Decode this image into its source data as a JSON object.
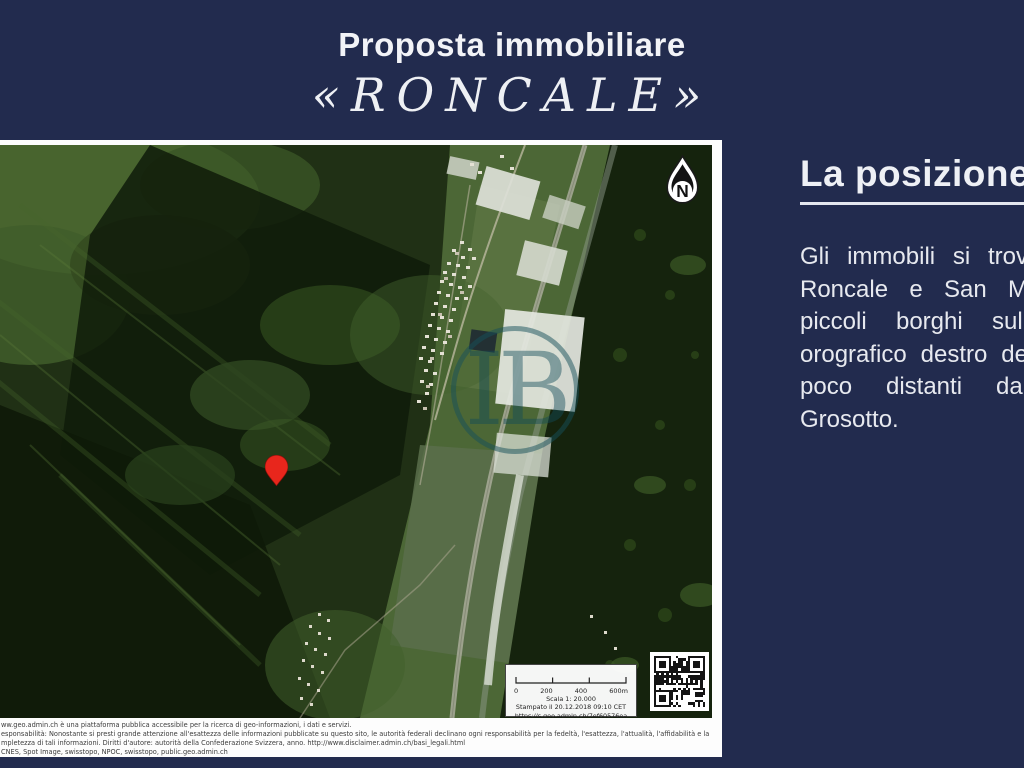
{
  "slide": {
    "title": "Proposta immobiliare",
    "subtitle": "«RONCALE»"
  },
  "right_panel": {
    "heading": "La posizione",
    "paragraph_lines": [
      "Gli immobili si trov",
      "Roncale e San M",
      "piccoli borghi sull",
      "orografico destro de",
      "poco distanti dal",
      "Grosotto."
    ]
  },
  "map": {
    "compass_label": "N",
    "watermark_text": "IB",
    "scale_box": {
      "ticks": [
        "0",
        "200",
        "400",
        "600m"
      ],
      "scale_text": "Scala 1: 20.000",
      "printed_text": "Stampato il 20.12.2018 09:10 CET",
      "url": "https://s.geo.admin.ch/7ef60576ea"
    },
    "disclaimer_lines": [
      "ww.geo.admin.ch è una piattaforma pubblica accessibile per la ricerca di geo-informazioni, i dati e servizi.",
      "esponsabilità: Nonostante si presti grande attenzione all'esattezza delle informazioni pubblicate su questo sito, le autorità federali declinano ogni responsabilità per la fedeltà, l'esattezza, l'attualità, l'affidabilità e la",
      "mpletezza di tali informazioni. Diritti d'autore: autorità della Confederazione Svizzera, anno. http://www.disclaimer.admin.ch/basi_legali.html",
      "CNES, Spot Image, swisstopo, NPOC, swisstopo, public.geo.admin.ch"
    ]
  },
  "colors": {
    "background_navy": "#222b4e",
    "marker_red": "#e8261c",
    "watermark_teal": "#16545c"
  }
}
